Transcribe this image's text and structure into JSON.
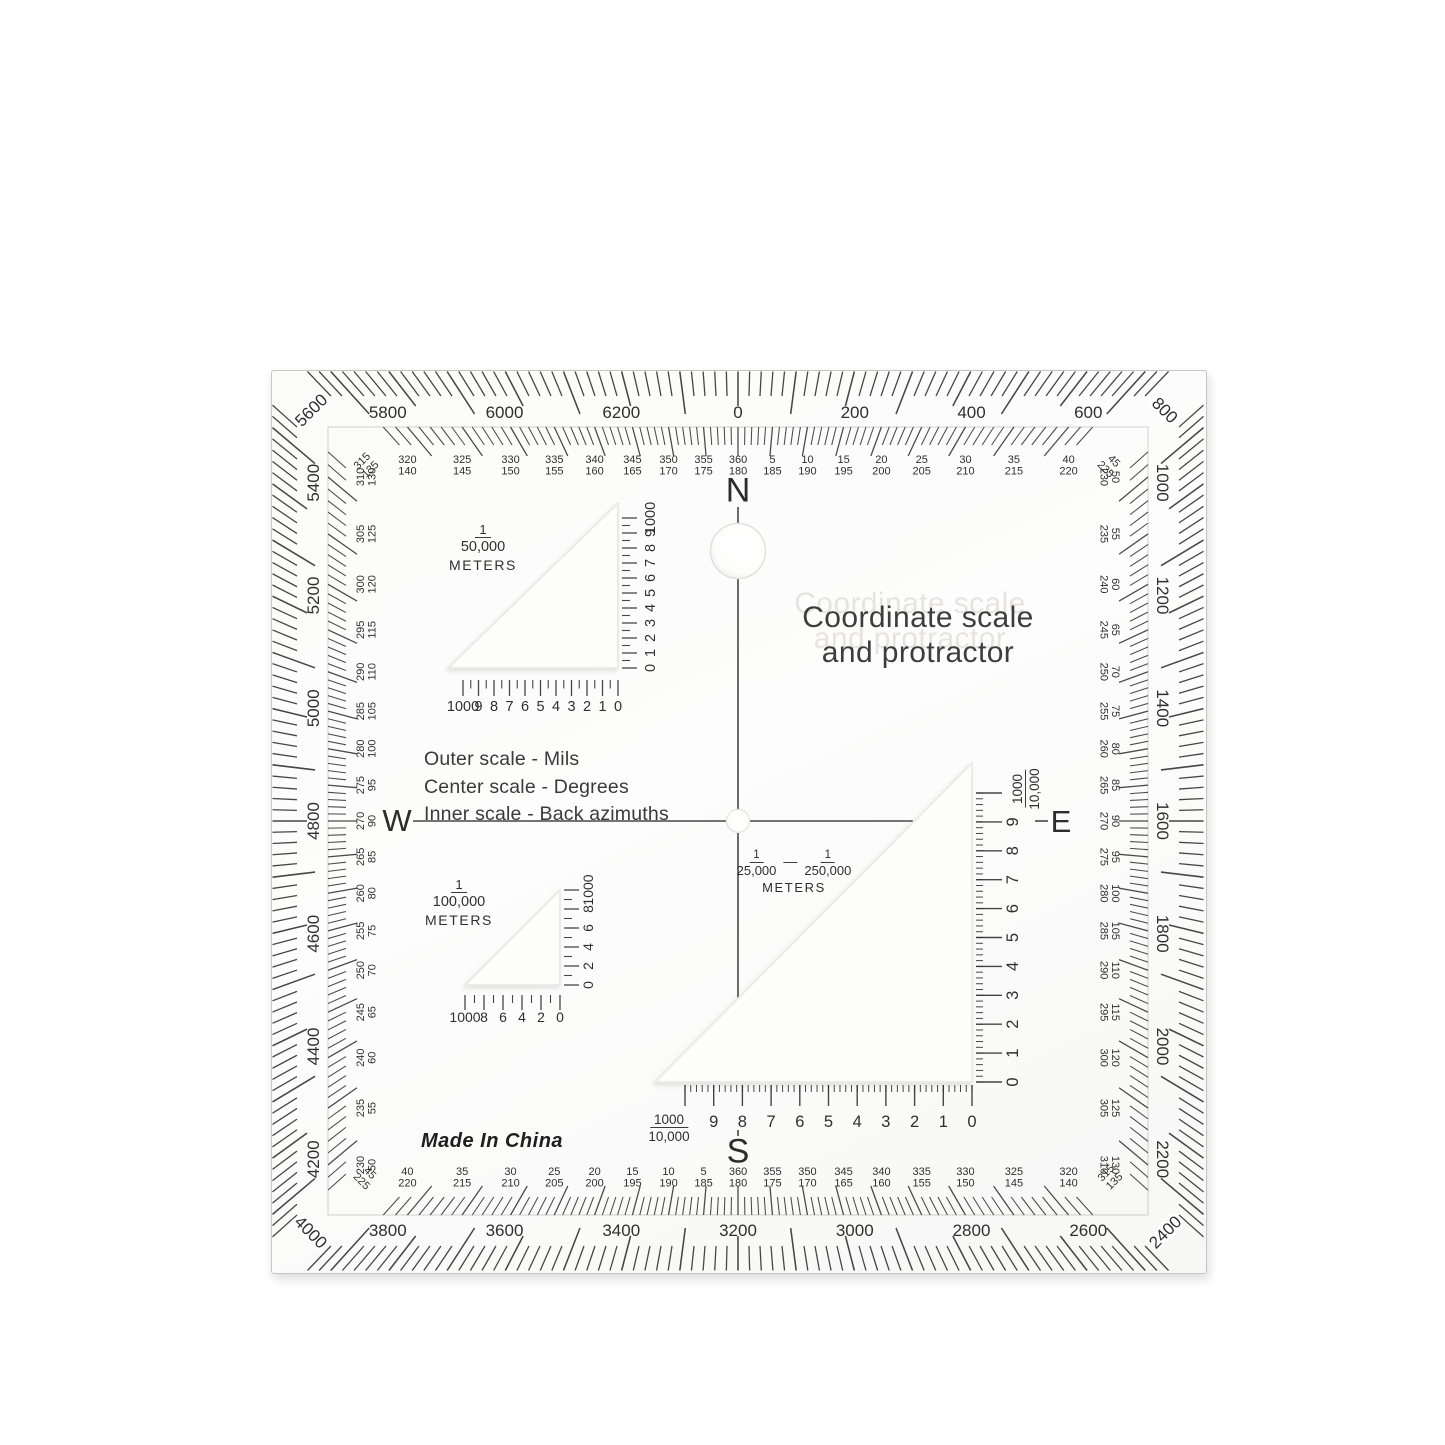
{
  "colors": {
    "ink": "#333333",
    "label_ink": "#2f2f2f",
    "plate": "#fcfcfc",
    "background": "#ffffff"
  },
  "plate_text": {
    "title_line1": "Coordinate scale",
    "title_line2": "and protractor",
    "legend": [
      "Outer scale - Mils",
      "Center scale - Degrees",
      "Inner scale - Back azimuths"
    ],
    "made_in": "Made In China"
  },
  "cardinals": {
    "north": "N",
    "south": "S",
    "east": "E",
    "west": "W"
  },
  "protractor": {
    "mils_labels": [
      "0",
      "200",
      "400",
      "600",
      "800",
      "1000",
      "1200",
      "1400",
      "1600",
      "1800",
      "2000",
      "2200",
      "2400",
      "2600",
      "2800",
      "3000",
      "3200",
      "3400",
      "3600",
      "3800",
      "4000",
      "4200",
      "4400",
      "4600",
      "4800",
      "5000",
      "5200",
      "5400",
      "5600",
      "5800",
      "6000",
      "6200"
    ],
    "degree_pairs": [
      "5/185",
      "10/190",
      "15/195",
      "20/200",
      "25/205",
      "30/210",
      "35/215",
      "40/220",
      "45/225",
      "50/230",
      "55/235",
      "60/240",
      "65/245",
      "70/250",
      "75/255",
      "80/260",
      "85/265",
      "90/270",
      "95/275",
      "100/280",
      "105/285",
      "110/290",
      "115/295",
      "120/300",
      "125/305",
      "130/310",
      "135/315",
      "140/320",
      "145/325",
      "150/330",
      "155/335",
      "160/340",
      "165/345",
      "170/350",
      "175/355",
      "180/360",
      "185/5",
      "190/10",
      "195/15",
      "200/20",
      "205/25",
      "210/30",
      "215/35",
      "220/40",
      "225/45",
      "230/50",
      "235/55",
      "240/60",
      "245/65",
      "250/70",
      "255/75",
      "260/80",
      "265/85",
      "270/90",
      "275/95",
      "280/100",
      "285/105",
      "290/110",
      "295/115",
      "300/120",
      "305/125",
      "310/130",
      "315/135",
      "320/140",
      "325/145",
      "330/150",
      "335/155",
      "340/160",
      "345/165",
      "350/170",
      "355/175",
      "360/180"
    ]
  },
  "coordinate_scales": {
    "s50000": {
      "numerator": "1",
      "denominator": "50,000",
      "unit": "METERS",
      "bottom_numbers": [
        "1000",
        "9",
        "8",
        "7",
        "6",
        "5",
        "4",
        "3",
        "2",
        "1",
        "0"
      ],
      "side_numbers": [
        "0",
        "1",
        "2",
        "3",
        "4",
        "5",
        "6",
        "7",
        "8",
        "9",
        "1000"
      ]
    },
    "s100000": {
      "numerator": "1",
      "denominator": "100,000",
      "unit": "METERS",
      "bottom_numbers": [
        "1000",
        "8",
        "6",
        "4",
        "2",
        "0"
      ],
      "side_numbers": [
        "0",
        "2",
        "4",
        "6",
        "8",
        "1000"
      ]
    },
    "s25000_250000": {
      "numerator1": "1",
      "denominator1": "25,000",
      "numerator2": "1",
      "denominator2": "250,000",
      "unit": "METERS",
      "bottom_fraction": {
        "numerator": "1000",
        "denominator": "10,000"
      },
      "bottom_numbers": [
        "9",
        "8",
        "7",
        "6",
        "5",
        "4",
        "3",
        "2",
        "1",
        "0"
      ],
      "side_numbers": [
        "0",
        "1",
        "2",
        "3",
        "4",
        "5",
        "6",
        "7",
        "8",
        "9"
      ],
      "side_fraction": {
        "numerator": "1000",
        "denominator": "10,000"
      }
    }
  }
}
